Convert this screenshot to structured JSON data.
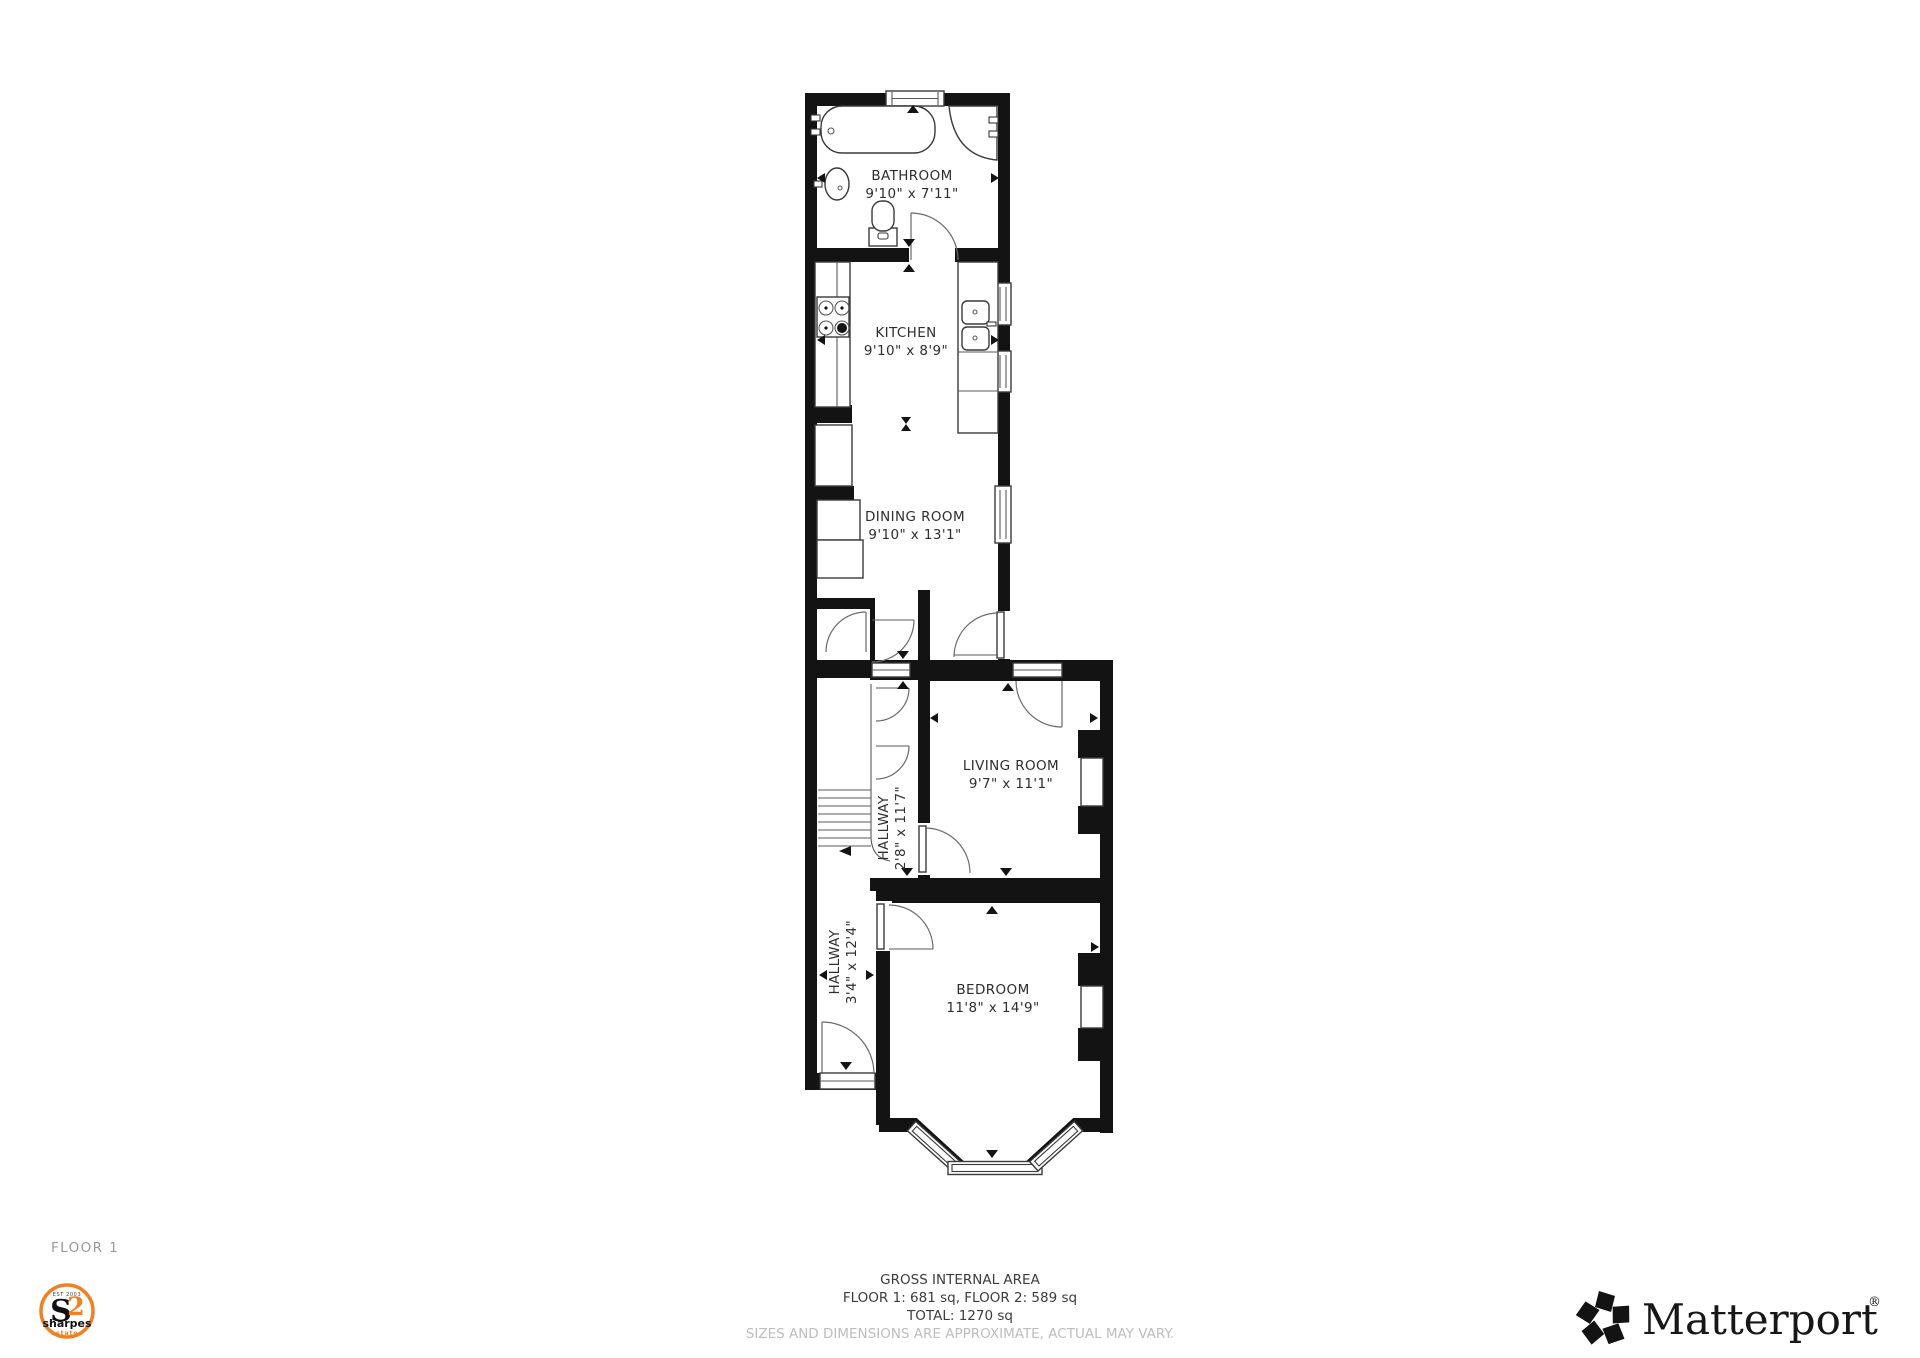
{
  "floor": {
    "label": "FLOOR 1"
  },
  "rooms": {
    "bathroom": {
      "name": "BATHROOM",
      "dims": "9'10\" x 7'11\""
    },
    "kitchen": {
      "name": "KITCHEN",
      "dims": "9'10\" x 8'9\""
    },
    "dining_room": {
      "name": "DINING ROOM",
      "dims": "9'10\" x 13'1\""
    },
    "living_room": {
      "name": "LIVING ROOM",
      "dims": "9'7\" x 11'1\""
    },
    "hallway_upper": {
      "name": "HALLWAY",
      "dims": "2'8\" x 11'7\""
    },
    "hallway_lower": {
      "name": "HALLWAY",
      "dims": "3'4\" x 12'4\""
    },
    "bedroom": {
      "name": "BEDROOM",
      "dims": "11'8\" x 14'9\""
    }
  },
  "footer": {
    "gross_internal_area": "GROSS INTERNAL AREA",
    "floor_breakdown": "FLOOR 1: 681 sq, FLOOR 2: 589 sq",
    "total": "TOTAL: 1270 sq",
    "disclaimer": "SIZES AND DIMENSIONS ARE APPROXIMATE, ACTUAL MAY VARY."
  },
  "branding": {
    "matterport_name": "Matterport",
    "matterport_reg": "®",
    "agency": {
      "mark_s": "S",
      "mark_2": "2",
      "name": "sharpes",
      "sub": "estates",
      "est": "EST 2003",
      "accent": "#F08021"
    },
    "wall_color": "#131313"
  }
}
